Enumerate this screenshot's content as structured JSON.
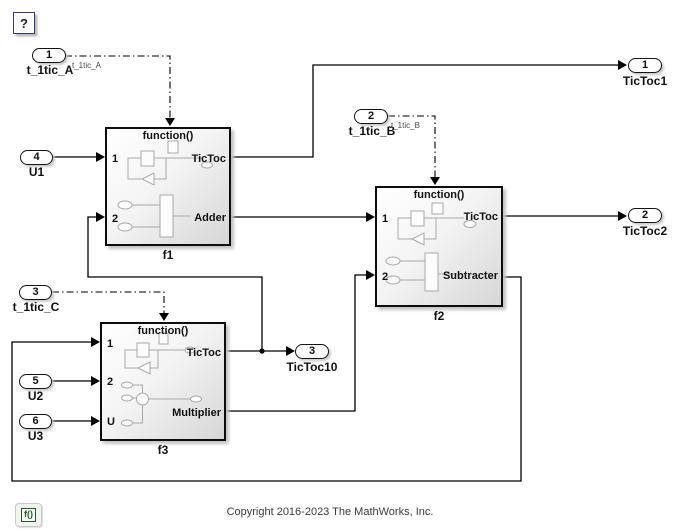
{
  "colors": {
    "wire": "#000000",
    "block_border": "#0d0d0d",
    "help_border": "#2d3a8c",
    "badge_green": "#1b5e20",
    "copyright_text": "#3c3c3c"
  },
  "help_button": {
    "label": "?"
  },
  "inports": [
    {
      "num": "1",
      "label": "t_1tic_A",
      "signal": "t_1tic_A"
    },
    {
      "num": "4",
      "label": "U1"
    },
    {
      "num": "2",
      "label": "t_1tic_B",
      "signal": "t_1tic_B"
    },
    {
      "num": "3",
      "label": "t_1tic_C"
    },
    {
      "num": "5",
      "label": "U2"
    },
    {
      "num": "6",
      "label": "U3"
    }
  ],
  "outports": [
    {
      "num": "1",
      "label": "TicToc1"
    },
    {
      "num": "2",
      "label": "TicToc2"
    },
    {
      "num": "3",
      "label": "TicToc10"
    }
  ],
  "subsystems": [
    {
      "name": "f1",
      "trigger": "function()",
      "in1": "1",
      "in2": "2",
      "out1": "TicToc",
      "out2": "Adder"
    },
    {
      "name": "f2",
      "trigger": "function()",
      "in1": "1",
      "in2": "2",
      "out1": "TicToc",
      "out2": "Subtracter"
    },
    {
      "name": "f3",
      "trigger": "function()",
      "in1": "1",
      "in2": "2",
      "in3": "U",
      "out1": "TicToc",
      "out2": "Multiplier"
    }
  ],
  "footer": {
    "badge": "f()",
    "copyright": "Copyright 2016-2023 The MathWorks, Inc."
  }
}
